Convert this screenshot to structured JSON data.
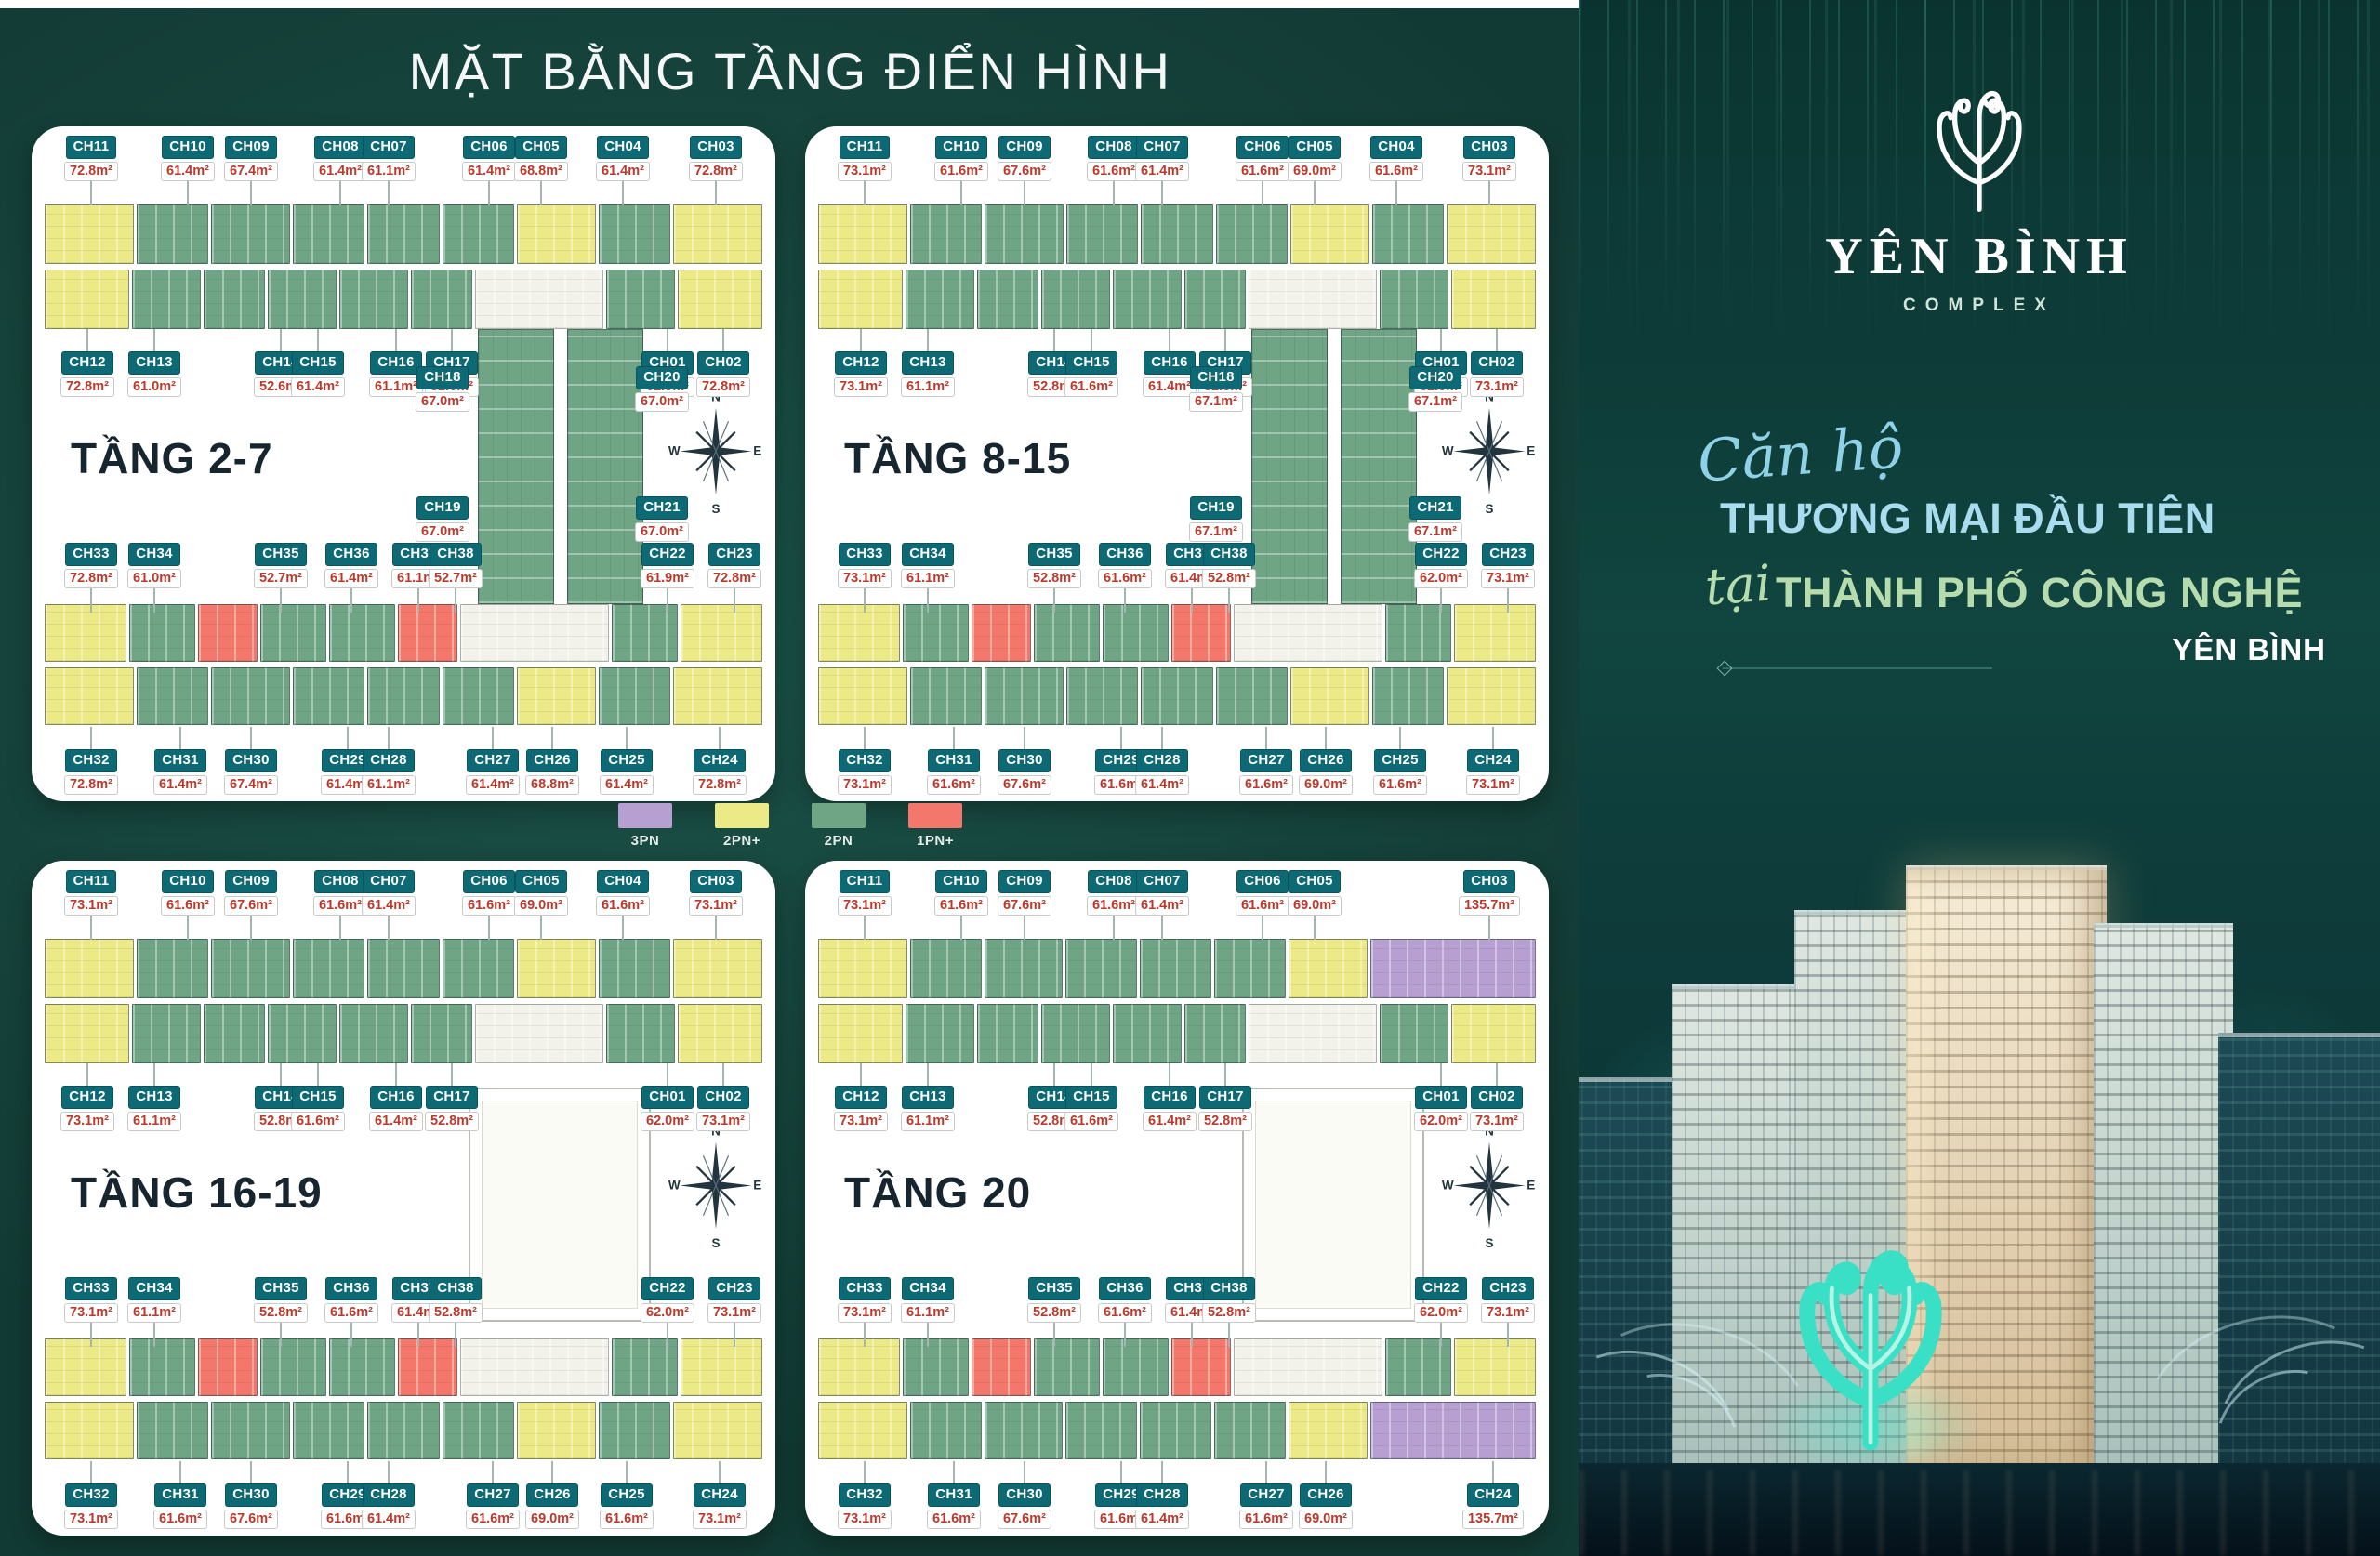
{
  "title": "MẶT BẰNG TẦNG ĐIỂN HÌNH",
  "legend": [
    {
      "label": "3PN",
      "color": "#b79fd2"
    },
    {
      "label": "2PN+",
      "color": "#ece987"
    },
    {
      "label": "2PN",
      "color": "#6fa585"
    },
    {
      "label": "1PN+",
      "color": "#f3776b"
    }
  ],
  "compass": {
    "n": "N",
    "e": "E",
    "s": "S",
    "w": "W"
  },
  "colors": {
    "background": "#16453d",
    "panel_teal": "#0d3b37",
    "card": "#ffffff",
    "unit_label": "#0d6a75",
    "area_text": "#b93a2c",
    "floor_title": "#17262e",
    "tagline_blue": "#a8dcee",
    "tagline_green": "#b6dcae",
    "unit_types": {
      "3PN": "#b79fd2",
      "2PN+": "#ece987",
      "2PN": "#6fa585",
      "1PN+": "#f3776b"
    }
  },
  "plans": [
    {
      "floor_label": "TẦNG 2-7",
      "rows": {
        "top": [
          [
            "CH11",
            "72.8m²",
            "2PN+"
          ],
          [
            "CH10",
            "61.4m²",
            "2PN"
          ],
          [
            "CH09",
            "67.4m²",
            "2PN"
          ],
          [
            "CH08",
            "61.4m²",
            "2PN"
          ],
          [
            "CH07",
            "61.1m²",
            "2PN"
          ],
          [
            "CH06",
            "61.4m²",
            "2PN"
          ],
          [
            "CH05",
            "68.8m²",
            "2PN+"
          ],
          [
            "CH04",
            "61.4m²",
            "2PN"
          ],
          [
            "CH03",
            "72.8m²",
            "2PN+"
          ]
        ],
        "upper": [
          [
            "CH12",
            "72.8m²",
            "2PN+"
          ],
          [
            "CH13",
            "61.0m²",
            "2PN"
          ],
          [
            "CH14",
            "52.6m²",
            "2PN"
          ],
          [
            "CH15",
            "61.4m²",
            "2PN"
          ],
          [
            "CH16",
            "61.1m²",
            "2PN"
          ],
          [
            "CH17",
            "52.6m²",
            "2PN"
          ],
          [
            "CH01",
            "61.9m²",
            "2PN"
          ],
          [
            "CH02",
            "72.8m²",
            "2PN+"
          ]
        ],
        "lower": [
          [
            "CH33",
            "72.8m²",
            "2PN+"
          ],
          [
            "CH34",
            "61.0m²",
            "2PN"
          ],
          [
            "CH35",
            "52.7m²",
            "1PN+"
          ],
          [
            "CH36",
            "61.4m²",
            "2PN"
          ],
          [
            "CH37",
            "61.1m²",
            "2PN"
          ],
          [
            "CH38",
            "52.7m²",
            "1PN+"
          ],
          [
            "CH22",
            "61.9m²",
            "2PN"
          ],
          [
            "CH23",
            "72.8m²",
            "2PN+"
          ]
        ],
        "bottom": [
          [
            "CH32",
            "72.8m²",
            "2PN+"
          ],
          [
            "CH31",
            "61.4m²",
            "2PN"
          ],
          [
            "CH30",
            "67.4m²",
            "2PN"
          ],
          [
            "CH29",
            "61.4m²",
            "2PN"
          ],
          [
            "CH28",
            "61.1m²",
            "2PN"
          ],
          [
            "CH27",
            "61.4m²",
            "2PN"
          ],
          [
            "CH26",
            "68.8m²",
            "2PN+"
          ],
          [
            "CH25",
            "61.4m²",
            "2PN"
          ],
          [
            "CH24",
            "72.8m²",
            "2PN+"
          ]
        ]
      },
      "center": [
        [
          "CH18",
          "67.0m²",
          "2PN"
        ],
        [
          "CH20",
          "67.0m²",
          "2PN"
        ],
        [
          "CH19",
          "67.0m²",
          "2PN"
        ],
        [
          "CH21",
          "67.0m²",
          "2PN"
        ]
      ]
    },
    {
      "floor_label": "TẦNG 8-15",
      "rows": {
        "top": [
          [
            "CH11",
            "73.1m²",
            "2PN+"
          ],
          [
            "CH10",
            "61.6m²",
            "2PN"
          ],
          [
            "CH09",
            "67.6m²",
            "2PN"
          ],
          [
            "CH08",
            "61.6m²",
            "2PN"
          ],
          [
            "CH07",
            "61.4m²",
            "2PN"
          ],
          [
            "CH06",
            "61.6m²",
            "2PN"
          ],
          [
            "CH05",
            "69.0m²",
            "2PN+"
          ],
          [
            "CH04",
            "61.6m²",
            "2PN"
          ],
          [
            "CH03",
            "73.1m²",
            "2PN+"
          ]
        ],
        "upper": [
          [
            "CH12",
            "73.1m²",
            "2PN+"
          ],
          [
            "CH13",
            "61.1m²",
            "2PN"
          ],
          [
            "CH14",
            "52.8m²",
            "2PN"
          ],
          [
            "CH15",
            "61.6m²",
            "2PN"
          ],
          [
            "CH16",
            "61.4m²",
            "2PN"
          ],
          [
            "CH17",
            "52.8m²",
            "2PN"
          ],
          [
            "CH01",
            "62.0m²",
            "2PN"
          ],
          [
            "CH02",
            "73.1m²",
            "2PN+"
          ]
        ],
        "lower": [
          [
            "CH33",
            "73.1m²",
            "2PN+"
          ],
          [
            "CH34",
            "61.1m²",
            "2PN"
          ],
          [
            "CH35",
            "52.8m²",
            "1PN+"
          ],
          [
            "CH36",
            "61.6m²",
            "2PN"
          ],
          [
            "CH37",
            "61.4m²",
            "2PN"
          ],
          [
            "CH38",
            "52.8m²",
            "1PN+"
          ],
          [
            "CH22",
            "62.0m²",
            "2PN"
          ],
          [
            "CH23",
            "73.1m²",
            "2PN+"
          ]
        ],
        "bottom": [
          [
            "CH32",
            "73.1m²",
            "2PN+"
          ],
          [
            "CH31",
            "61.6m²",
            "2PN"
          ],
          [
            "CH30",
            "67.6m²",
            "2PN"
          ],
          [
            "CH29",
            "61.6m²",
            "2PN"
          ],
          [
            "CH28",
            "61.4m²",
            "2PN"
          ],
          [
            "CH27",
            "61.6m²",
            "2PN"
          ],
          [
            "CH26",
            "69.0m²",
            "2PN+"
          ],
          [
            "CH25",
            "61.6m²",
            "2PN"
          ],
          [
            "CH24",
            "73.1m²",
            "2PN+"
          ]
        ]
      },
      "center": [
        [
          "CH18",
          "67.1m²",
          "2PN"
        ],
        [
          "CH20",
          "67.1m²",
          "2PN"
        ],
        [
          "CH19",
          "67.1m²",
          "2PN"
        ],
        [
          "CH21",
          "67.1m²",
          "2PN"
        ]
      ]
    },
    {
      "floor_label": "TẦNG 16-19",
      "rows": {
        "top": [
          [
            "CH11",
            "73.1m²",
            "2PN+"
          ],
          [
            "CH10",
            "61.6m²",
            "2PN"
          ],
          [
            "CH09",
            "67.6m²",
            "2PN"
          ],
          [
            "CH08",
            "61.6m²",
            "2PN"
          ],
          [
            "CH07",
            "61.4m²",
            "2PN"
          ],
          [
            "CH06",
            "61.6m²",
            "2PN"
          ],
          [
            "CH05",
            "69.0m²",
            "2PN+"
          ],
          [
            "CH04",
            "61.6m²",
            "2PN"
          ],
          [
            "CH03",
            "73.1m²",
            "2PN+"
          ]
        ],
        "upper": [
          [
            "CH12",
            "73.1m²",
            "2PN+"
          ],
          [
            "CH13",
            "61.1m²",
            "2PN"
          ],
          [
            "CH14",
            "52.8m²",
            "2PN"
          ],
          [
            "CH15",
            "61.6m²",
            "2PN"
          ],
          [
            "CH16",
            "61.4m²",
            "2PN"
          ],
          [
            "CH17",
            "52.8m²",
            "2PN"
          ],
          [
            "CH01",
            "62.0m²",
            "2PN"
          ],
          [
            "CH02",
            "73.1m²",
            "2PN+"
          ]
        ],
        "lower": [
          [
            "CH33",
            "73.1m²",
            "2PN+"
          ],
          [
            "CH34",
            "61.1m²",
            "2PN"
          ],
          [
            "CH35",
            "52.8m²",
            "1PN+"
          ],
          [
            "CH36",
            "61.6m²",
            "2PN"
          ],
          [
            "CH37",
            "61.4m²",
            "2PN"
          ],
          [
            "CH38",
            "52.8m²",
            "1PN+"
          ],
          [
            "CH22",
            "62.0m²",
            "2PN"
          ],
          [
            "CH23",
            "73.1m²",
            "2PN+"
          ]
        ],
        "bottom": [
          [
            "CH32",
            "73.1m²",
            "2PN+"
          ],
          [
            "CH31",
            "61.6m²",
            "2PN"
          ],
          [
            "CH30",
            "67.6m²",
            "2PN"
          ],
          [
            "CH29",
            "61.6m²",
            "2PN"
          ],
          [
            "CH28",
            "61.4m²",
            "2PN"
          ],
          [
            "CH27",
            "61.6m²",
            "2PN"
          ],
          [
            "CH26",
            "69.0m²",
            "2PN+"
          ],
          [
            "CH25",
            "61.6m²",
            "2PN"
          ],
          [
            "CH24",
            "73.1m²",
            "2PN+"
          ]
        ]
      },
      "center": []
    },
    {
      "floor_label": "TẦNG 20",
      "rows": {
        "top": [
          [
            "CH11",
            "73.1m²",
            "2PN+"
          ],
          [
            "CH10",
            "61.6m²",
            "2PN"
          ],
          [
            "CH09",
            "67.6m²",
            "2PN"
          ],
          [
            "CH08",
            "61.6m²",
            "2PN"
          ],
          [
            "CH07",
            "61.4m²",
            "2PN"
          ],
          [
            "CH06",
            "61.6m²",
            "2PN"
          ],
          [
            "CH05",
            "69.0m²",
            "2PN+"
          ],
          [
            "CH03",
            "135.7m²",
            "3PN"
          ]
        ],
        "upper": [
          [
            "CH12",
            "73.1m²",
            "2PN+"
          ],
          [
            "CH13",
            "61.1m²",
            "2PN"
          ],
          [
            "CH14",
            "52.8m²",
            "2PN"
          ],
          [
            "CH15",
            "61.6m²",
            "2PN"
          ],
          [
            "CH16",
            "61.4m²",
            "2PN"
          ],
          [
            "CH17",
            "52.8m²",
            "2PN"
          ],
          [
            "CH01",
            "62.0m²",
            "2PN"
          ],
          [
            "CH02",
            "73.1m²",
            "2PN+"
          ]
        ],
        "lower": [
          [
            "CH33",
            "73.1m²",
            "2PN+"
          ],
          [
            "CH34",
            "61.1m²",
            "2PN"
          ],
          [
            "CH35",
            "52.8m²",
            "1PN+"
          ],
          [
            "CH36",
            "61.6m²",
            "2PN"
          ],
          [
            "CH37",
            "61.4m²",
            "2PN"
          ],
          [
            "CH38",
            "52.8m²",
            "1PN+"
          ],
          [
            "CH22",
            "62.0m²",
            "2PN"
          ],
          [
            "CH23",
            "73.1m²",
            "2PN+"
          ]
        ],
        "bottom": [
          [
            "CH32",
            "73.1m²",
            "2PN+"
          ],
          [
            "CH31",
            "61.6m²",
            "2PN"
          ],
          [
            "CH30",
            "67.6m²",
            "2PN"
          ],
          [
            "CH29",
            "61.6m²",
            "2PN"
          ],
          [
            "CH28",
            "61.4m²",
            "2PN"
          ],
          [
            "CH27",
            "61.6m²",
            "2PN"
          ],
          [
            "CH26",
            "69.0m²",
            "2PN+"
          ],
          [
            "CH24",
            "135.7m²",
            "3PN"
          ]
        ]
      },
      "center": []
    }
  ],
  "brand": {
    "name": "YÊN BÌNH",
    "complex": "COMPLEX"
  },
  "tagline": {
    "script1": "Căn hộ",
    "line1": "THƯƠNG MẠI ĐẦU TIÊN",
    "script2": "tại",
    "line2": "THÀNH PHỐ CÔNG NGHỆ",
    "line3": "YÊN BÌNH"
  }
}
